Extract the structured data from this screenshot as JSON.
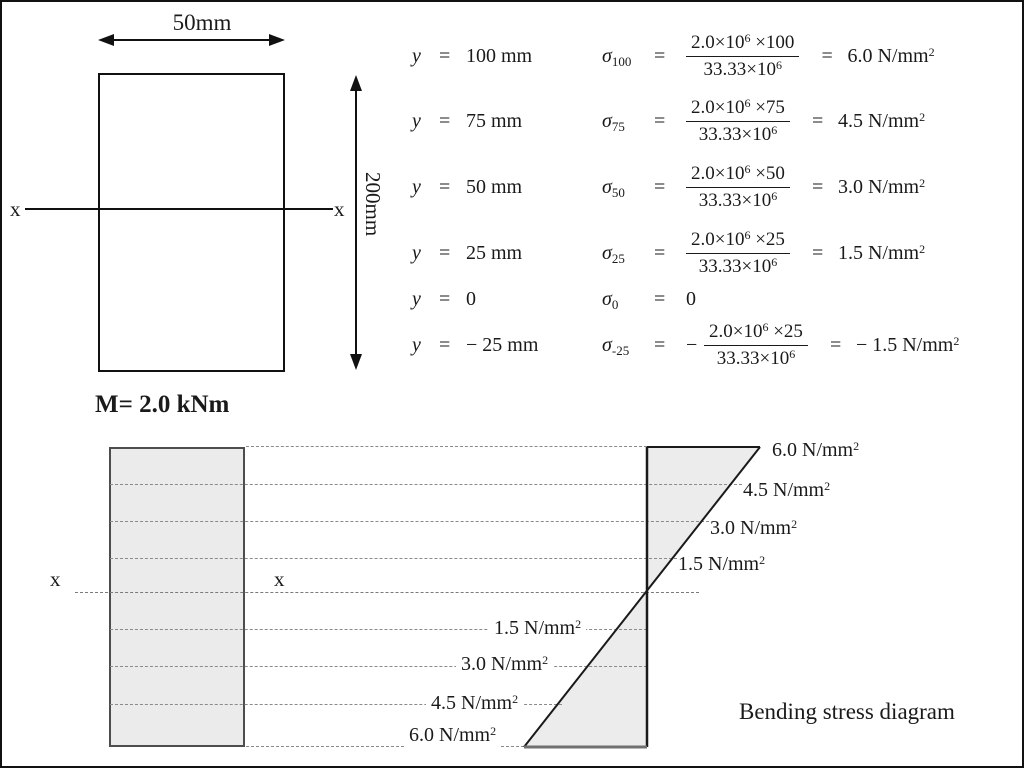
{
  "top_left": {
    "width_label": "50mm",
    "height_label": "200mm",
    "axis_left": "x",
    "axis_right": "x",
    "moment_label": "M= 2.0 kNm"
  },
  "equations": {
    "rows": [
      {
        "y_sym": "y",
        "eq": "=",
        "y_value": "100 mm",
        "sigma": "σ",
        "sigma_sub": "100",
        "eq2": "=",
        "num_base": "2.0×10",
        "num_exp": "6",
        "num_tail": " ×100",
        "den_base": "33.33×10",
        "den_exp": "6",
        "eq3": "=",
        "res_base": "6.0 N/mm",
        "res_exp": "2"
      },
      {
        "y_sym": "y",
        "eq": "=",
        "y_value": "75 mm",
        "sigma": "σ",
        "sigma_sub": "75",
        "eq2": "=",
        "num_base": "2.0×10",
        "num_exp": "6",
        "num_tail": " ×75",
        "den_base": "33.33×10",
        "den_exp": "6",
        "eq3": "=",
        "res_base": "4.5 N/mm",
        "res_exp": "2"
      },
      {
        "y_sym": "y",
        "eq": "=",
        "y_value": "50 mm",
        "sigma": "σ",
        "sigma_sub": "50",
        "eq2": "=",
        "num_base": "2.0×10",
        "num_exp": "6",
        "num_tail": " ×50",
        "den_base": "33.33×10",
        "den_exp": "6",
        "eq3": "=",
        "res_base": "3.0 N/mm",
        "res_exp": "2"
      },
      {
        "y_sym": "y",
        "eq": "=",
        "y_value": "25 mm",
        "sigma": "σ",
        "sigma_sub": "25",
        "eq2": "=",
        "num_base": "2.0×10",
        "num_exp": "6",
        "num_tail": " ×25",
        "den_base": "33.33×10",
        "den_exp": "6",
        "eq3": "=",
        "res_base": "1.5 N/mm",
        "res_exp": "2"
      },
      {
        "y_sym": "y",
        "eq": "=",
        "y_value": "0",
        "sigma": "σ",
        "sigma_sub": "0",
        "eq2": "=",
        "res_base": "0"
      },
      {
        "y_sym": "y",
        "eq": "=",
        "y_value": "− 25 mm",
        "sigma": "σ",
        "sigma_sub": "-25",
        "eq2": "=",
        "neg": "−",
        "num_base": "2.0×10",
        "num_exp": "6",
        "num_tail": " ×25",
        "den_base": "33.33×10",
        "den_exp": "6",
        "eq3": "=",
        "res_base": "− 1.5 N/mm",
        "res_exp": "2"
      }
    ]
  },
  "bottom": {
    "axis_left": "x",
    "axis_mid": "x",
    "caption": "Bending stress diagram",
    "labels_upper": [
      {
        "base": "6.0 N/mm",
        "exp": "2"
      },
      {
        "base": "4.5 N/mm",
        "exp": "2"
      },
      {
        "base": "3.0 N/mm",
        "exp": "2"
      },
      {
        "base": "1.5 N/mm",
        "exp": "2"
      }
    ],
    "labels_lower": [
      {
        "base": "1.5 N/mm",
        "exp": "2"
      },
      {
        "base": "3.0 N/mm",
        "exp": "2"
      },
      {
        "base": "4.5 N/mm",
        "exp": "2"
      },
      {
        "base": "6.0 N/mm",
        "exp": "2"
      }
    ]
  },
  "colors": {
    "ink": "#1a1a1a",
    "dash": "#8a8a8a",
    "shape_fill": "#ececec",
    "background": "#ffffff"
  }
}
